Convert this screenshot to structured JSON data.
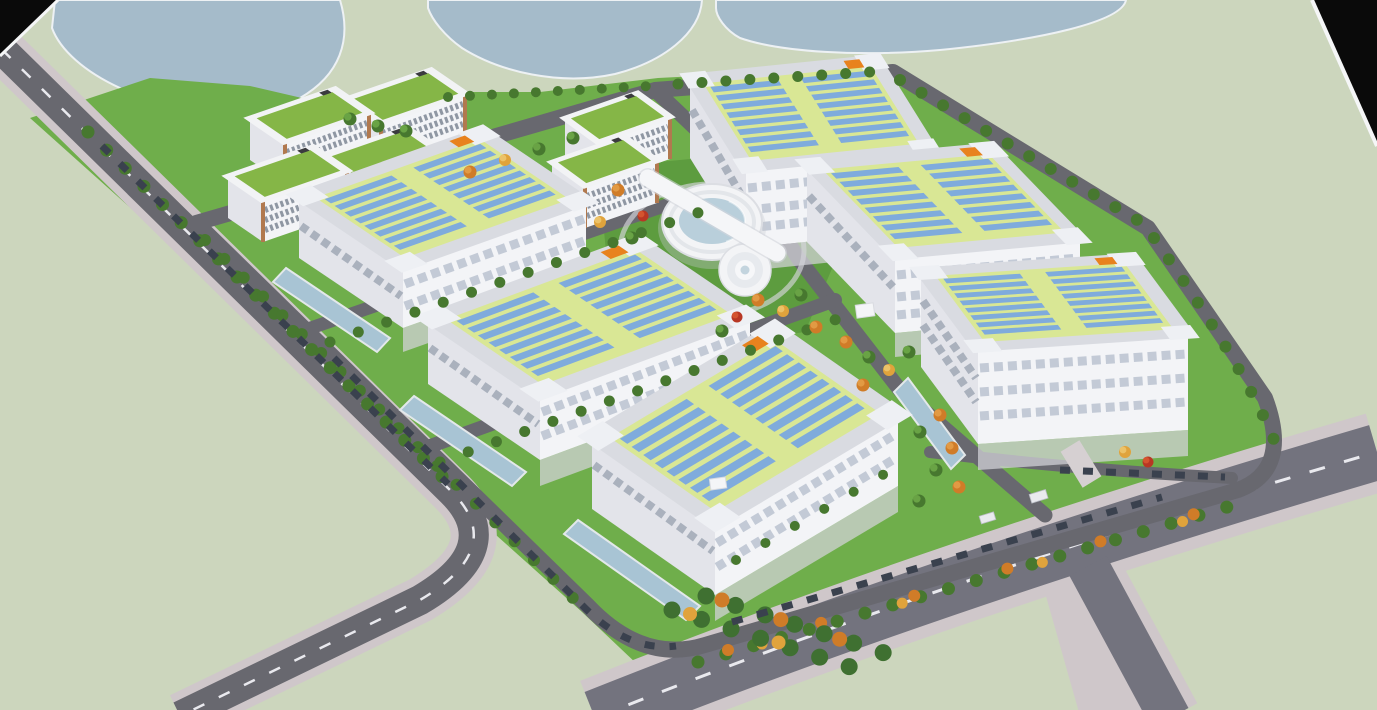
{
  "meta": {
    "title": "Aerial 3D rendering of an industrial logistics campus master plan",
    "type": "architectural-visualization",
    "view": "oblique bird's-eye aerial",
    "visible_text": "none"
  },
  "palette": {
    "land": "#ccd6bd",
    "water": "#a5bbca",
    "shore": "#edf1f4",
    "lawn": "#6fae4b",
    "lawn_dark": "#5d9c3f",
    "road": "#68686f",
    "road_major": "#73737e",
    "sidewalk": "#cfc7ca",
    "dash": "#e9e9ee",
    "roof": "#d9dbe1",
    "parapet": "#eef0f4",
    "lime": "#d9e795",
    "solar": "#7fabdc",
    "facade": "#f3f4f7",
    "facade_shadow": "#e3e4ea",
    "office_roof": "#85b647",
    "office_trim": "#b1794f",
    "hub": "#f3f4f6",
    "glass": "#b9cfdb",
    "tree": "#47782f",
    "tree_hi": "#69a345",
    "autumn": "#d07c28",
    "autumn_yellow": "#e0a33c",
    "autumn_red": "#b83724",
    "car": "#3a414e",
    "pool": "#a8c4d4",
    "vent": "#e8821e",
    "apron": "#d4d4da",
    "void": "#0a0a0a"
  },
  "site": {
    "buildings": [
      {
        "id": "warehouse-1",
        "kind": "logistics warehouse",
        "roof": "solar array",
        "solar_rows": 16,
        "position": "upper-left"
      },
      {
        "id": "warehouse-2",
        "kind": "logistics warehouse",
        "roof": "solar array",
        "solar_rows": 16,
        "position": "middle-left"
      },
      {
        "id": "warehouse-3",
        "kind": "logistics warehouse",
        "roof": "solar array",
        "solar_rows": 16,
        "position": "bottom-center"
      },
      {
        "id": "warehouse-4",
        "kind": "logistics warehouse",
        "roof": "solar array",
        "solar_rows": 16,
        "position": "top-center"
      },
      {
        "id": "warehouse-5",
        "kind": "logistics warehouse",
        "roof": "solar array",
        "solar_rows": 16,
        "position": "right-middle"
      },
      {
        "id": "warehouse-6",
        "kind": "logistics warehouse",
        "roof": "solar array",
        "solar_rows": 16,
        "position": "right-bottom"
      },
      {
        "id": "office-1",
        "kind": "office block",
        "roof": "green roof",
        "position": "northwest cluster"
      },
      {
        "id": "office-2",
        "kind": "office block",
        "roof": "green roof",
        "position": "northwest cluster"
      },
      {
        "id": "office-3",
        "kind": "office block",
        "roof": "green roof",
        "position": "northwest cluster"
      },
      {
        "id": "office-4",
        "kind": "office block",
        "roof": "green roof",
        "position": "northwest cluster"
      },
      {
        "id": "office-5",
        "kind": "office block",
        "roof": "green roof",
        "position": "top-center pair"
      },
      {
        "id": "office-6",
        "kind": "office block",
        "roof": "green roof",
        "position": "top-center pair"
      },
      {
        "id": "central-hub",
        "kind": "circular hub building",
        "features": [
          "glass atrium",
          "diagonal roof bar",
          "cylindrical annex"
        ],
        "position": "campus center"
      },
      {
        "id": "pavilion-1",
        "kind": "small utility pavilion",
        "position": "southeast of warehouse-5"
      },
      {
        "id": "pavilion-2",
        "kind": "small utility pavilion",
        "position": "south of warehouse-3"
      }
    ],
    "water_bodies": 3,
    "landscape": {
      "street_trees_approx": 130,
      "autumn_trees_approx": 24,
      "hedge_shrubs_approx": 26,
      "reflecting_pools": 4,
      "lawns": "bright green campus lawns on pale open land"
    },
    "transport": {
      "roads": [
        "external avenue along west edge with dashed lane line",
        "major boulevard bottom-right with dashed lane line",
        "boulevard branch to bottom edge",
        "campus ring road",
        "central spine road",
        "two internal cross streets"
      ],
      "parked_cars_approx": 40,
      "trucks": 2
    },
    "void_corners": [
      "top-left",
      "top-right"
    ]
  }
}
